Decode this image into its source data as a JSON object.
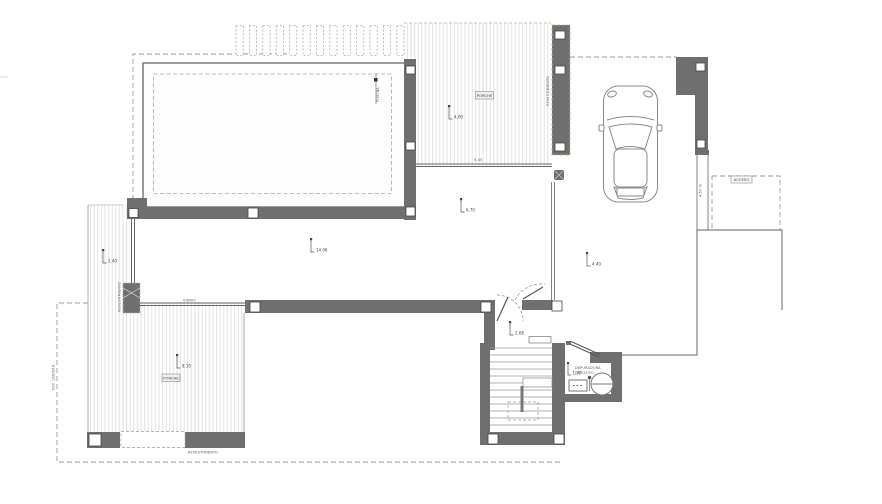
{
  "drawing": {
    "type": "architectural-floor-plan",
    "labels": {
      "porch_top": "PORCHE",
      "porch_bottom": "PORCHE",
      "access": "ACCESO",
      "cladding_right": "REVESTIMIENTO",
      "cladding_left": "REVESTIMIENTO",
      "cladding_bottom": "REVESTIMIENTO",
      "pool": "PISCINA",
      "glass": "VIDRIO",
      "boundary": "SEP. LINDERO",
      "side_dim": "4.50 m",
      "porch_dim": "5.45",
      "utility_line1": "DEPURADORA",
      "utility_line2": "DEPOSITO"
    },
    "level_markers": {
      "porch_top": "4.00",
      "terrace_edge": "6.70",
      "living": "14.06",
      "side_terrace": "1.40",
      "porch_bottom": "8.10",
      "entry": "2.68",
      "carport": "4.40",
      "utility": "1.70"
    },
    "colors": {
      "wall": "#6f6f6f",
      "line": "#555555",
      "hatch": "#dcdcdc",
      "dashed": "#9a9a9a",
      "edge_accent": "#b9b98f",
      "background": "#ffffff"
    }
  }
}
